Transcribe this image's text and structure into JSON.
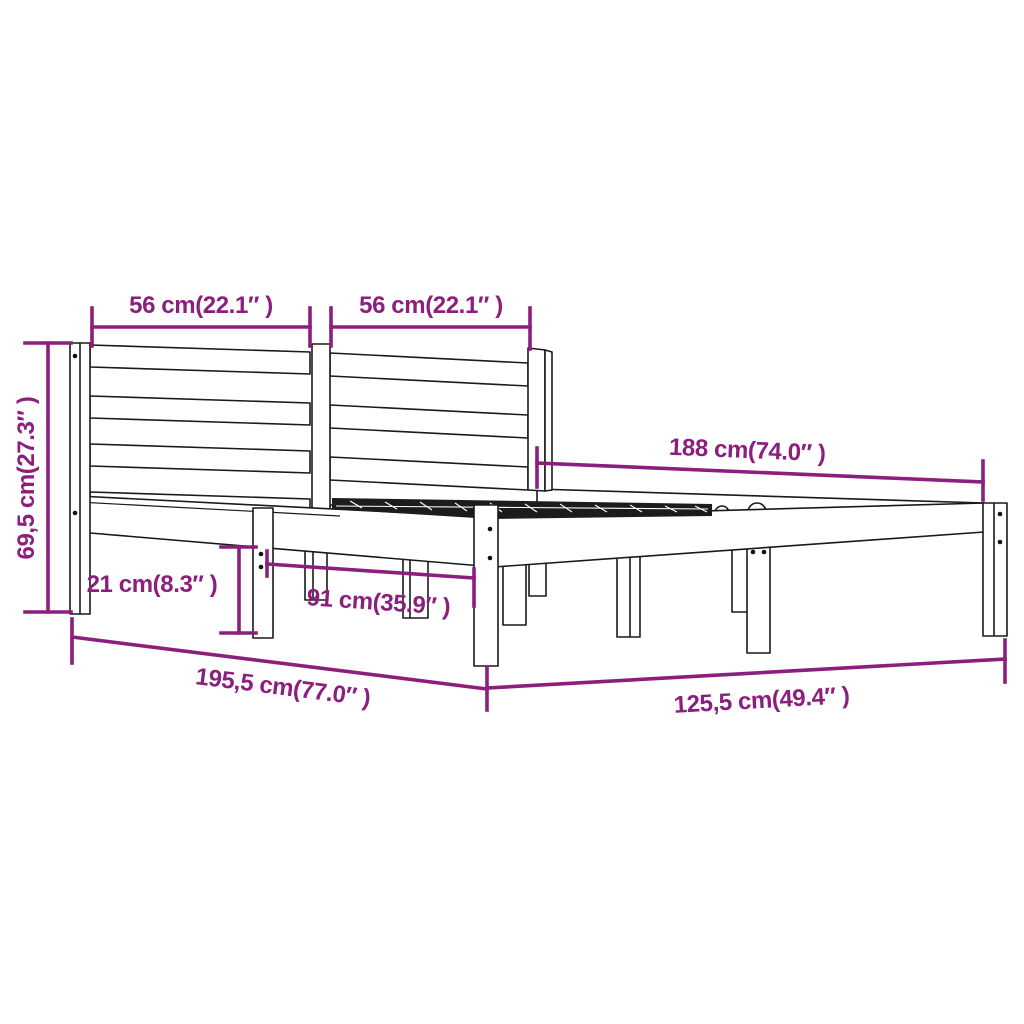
{
  "diagram": {
    "type": "furniture-dimension-drawing",
    "subject": "wooden bed frame with slatted headboard, side rails, legs and slat base",
    "background_color": "#ffffff",
    "line_color": "#1a1a1a",
    "accent_color": "#8C1E7D",
    "slat_fill_color": "#1c1c1c",
    "labels": {
      "headboard_left": "56 cm(22.1″ )",
      "headboard_right": "56 cm(22.1″ )",
      "height": "69,5 cm(27.3″ )",
      "length_top": "188 cm(74.0″ )",
      "clearance": "21 cm(8.3″ )",
      "leg_gap": "91 cm(35.9″ )",
      "length_bottom": "195,5 cm(77.0″ )",
      "width_bottom": "125,5 cm(49.4″ )"
    },
    "dimensions": [
      {
        "cm": "56",
        "inch": "22.1",
        "part": "headboard left section width"
      },
      {
        "cm": "56",
        "inch": "22.1",
        "part": "headboard right section width"
      },
      {
        "cm": "69,5",
        "inch": "27.3",
        "part": "headboard height"
      },
      {
        "cm": "188",
        "inch": "74.0",
        "part": "inner frame length"
      },
      {
        "cm": "21",
        "inch": "8.3",
        "part": "under-bed clearance"
      },
      {
        "cm": "91",
        "inch": "35.9",
        "part": "leg spacing"
      },
      {
        "cm": "195,5",
        "inch": "77.0",
        "part": "total length"
      },
      {
        "cm": "125,5",
        "inch": "49.4",
        "part": "total width"
      }
    ]
  }
}
